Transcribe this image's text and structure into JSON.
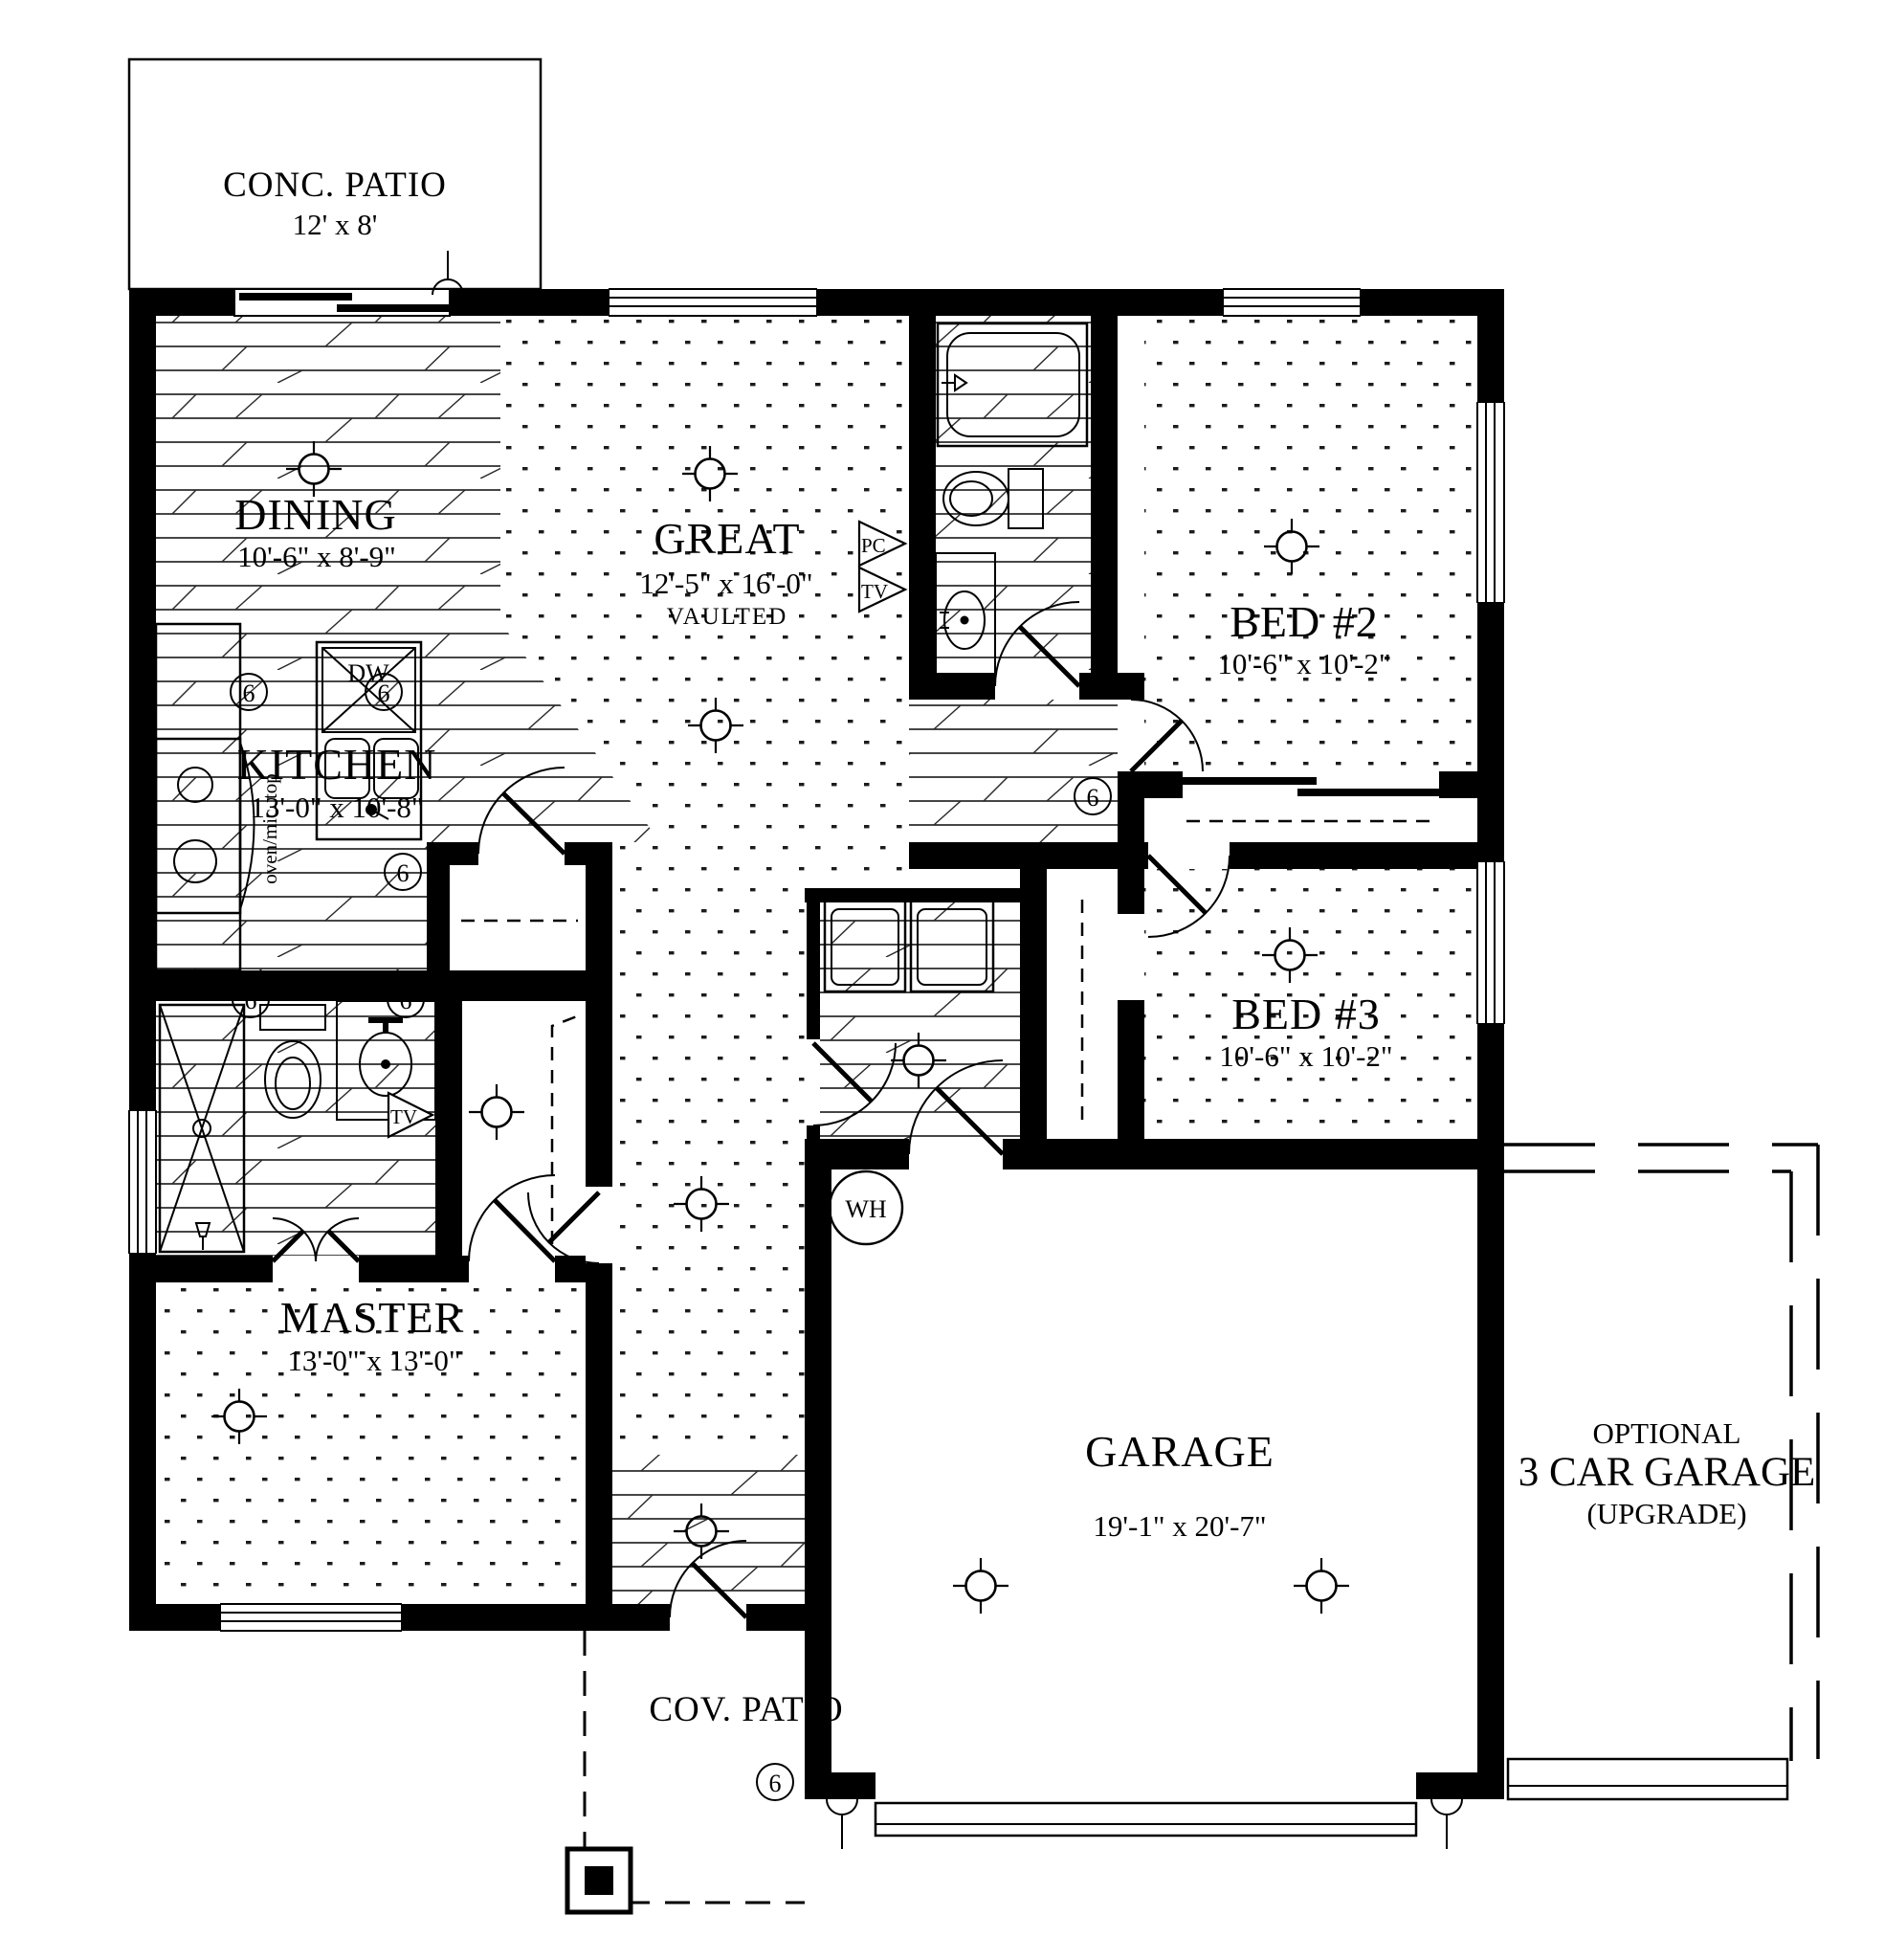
{
  "plan": {
    "rooms": {
      "conc_patio": {
        "name": "CONC. PATIO",
        "dims": "12' x 8'"
      },
      "dining": {
        "name": "DINING",
        "dims": "10'-6\" x 8'-9\""
      },
      "great": {
        "name": "GREAT",
        "dims": "12'-5\" x 16'-0\"",
        "note": "VAULTED"
      },
      "kitchen": {
        "name": "KITCHEN",
        "dims": "13'-0\" x 10'-8\""
      },
      "bed2": {
        "name": "BED #2",
        "dims": "10'-6\" x 10'-2\""
      },
      "bed3": {
        "name": "BED #3",
        "dims": "10'-6\" x 10'-2\""
      },
      "master": {
        "name": "MASTER",
        "dims": "13'-0\" x 13'-0\""
      },
      "garage": {
        "name": "GARAGE",
        "dims": "19'-1\" x 20'-7\""
      },
      "optional_garage": {
        "line1": "OPTIONAL",
        "line2": "3 CAR GARAGE",
        "line3": "(UPGRADE)"
      },
      "cov_patio": {
        "name": "COV. PATIO"
      }
    },
    "labels": {
      "water_heater": "WH",
      "dishwasher": "DW",
      "pc": "PC",
      "tv": "TV",
      "range": "oven/mic. top",
      "can_light": "6"
    },
    "colors": {
      "ink": "#000000",
      "paper": "#ffffff"
    }
  }
}
